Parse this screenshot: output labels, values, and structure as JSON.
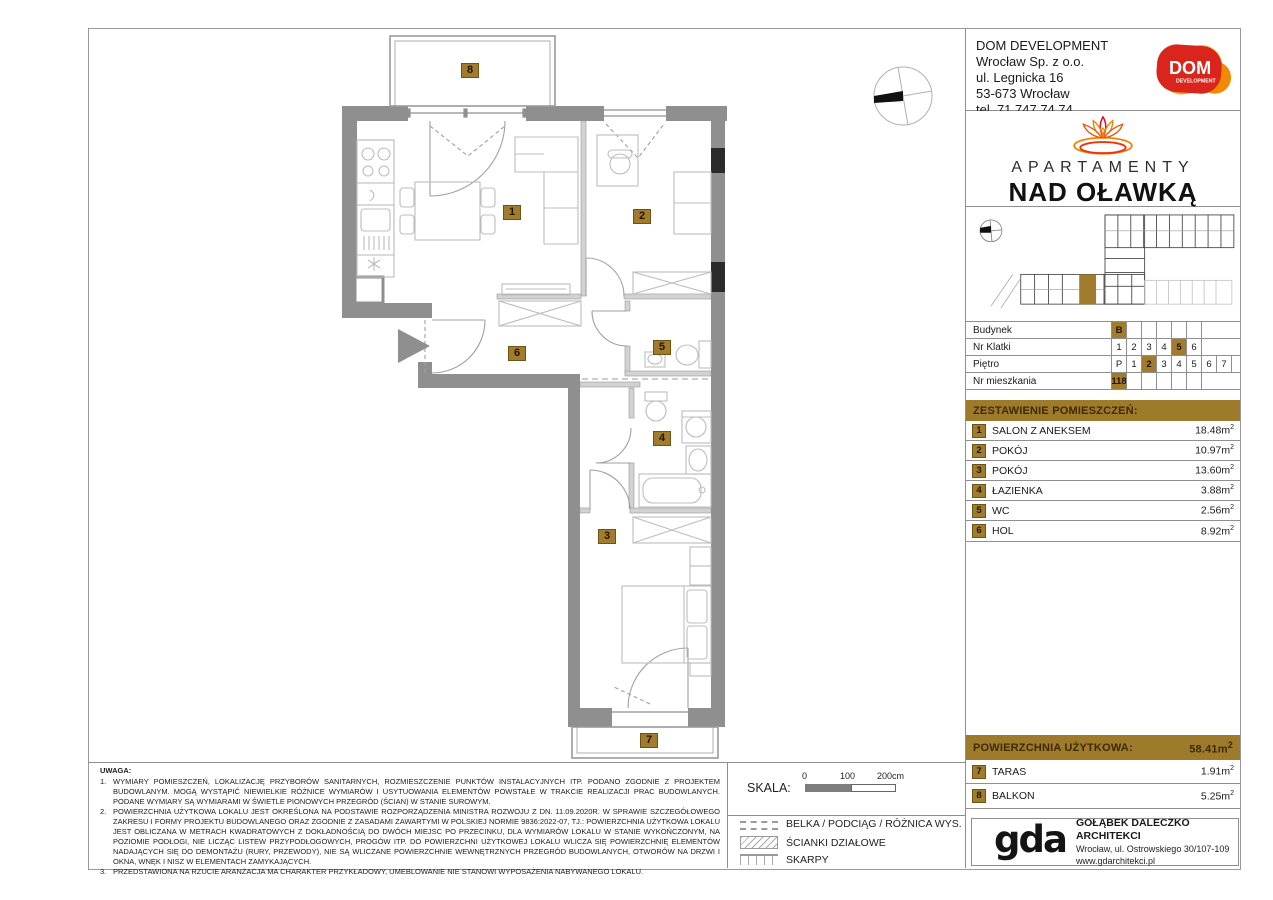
{
  "company": {
    "name": "DOM DEVELOPMENT",
    "lines": [
      "Wrocław Sp. z o.o.",
      "ul. Legnicka 16",
      "53-673 Wrocław",
      "tel. 71 747 74 74"
    ],
    "logo_text": "DOM",
    "logo_sub": "DEVELOPMENT"
  },
  "brand": {
    "line1": "APARTAMENTY",
    "line2": "NAD OŁAWKĄ"
  },
  "unit": {
    "rows": [
      {
        "label": "Budynek",
        "options": [
          "B",
          "",
          "",
          "",
          "",
          ""
        ],
        "selected": "B"
      },
      {
        "label": "Nr Klatki",
        "options": [
          "1",
          "2",
          "3",
          "4",
          "5",
          "6"
        ],
        "selected": "5"
      },
      {
        "label": "Piętro",
        "options": [
          "P",
          "1",
          "2",
          "3",
          "4",
          "5",
          "6",
          "7"
        ],
        "selected": "2"
      },
      {
        "label": "Nr mieszkania",
        "options": [
          "118",
          "",
          "",
          "",
          "",
          ""
        ],
        "selected": "118"
      }
    ]
  },
  "rooms": {
    "header": "ZESTAWIENIE POMIESZCZEŃ:",
    "items": [
      {
        "no": "1",
        "name": "SALON Z ANEKSEM",
        "area": "18.48"
      },
      {
        "no": "2",
        "name": "POKÓJ",
        "area": "10.97"
      },
      {
        "no": "3",
        "name": "POKÓJ",
        "area": "13.60"
      },
      {
        "no": "4",
        "name": "ŁAZIENKA",
        "area": "3.88"
      },
      {
        "no": "5",
        "name": "WC",
        "area": "2.56"
      },
      {
        "no": "6",
        "name": "HOL",
        "area": "8.92"
      }
    ]
  },
  "totals": {
    "header": "POWIERZCHNIA UŻYTKOWA:",
    "value": "58.41",
    "outdoor": [
      {
        "no": "7",
        "name": "TARAS",
        "area": "1.91"
      },
      {
        "no": "8",
        "name": "BALKON",
        "area": "5.25"
      }
    ]
  },
  "units": {
    "m": "m",
    "exp": "2"
  },
  "notes": {
    "title": "UWAGA:",
    "items": [
      {
        "no": "1.",
        "text": "WYMIARY POMIESZCZEŃ, LOKALIZACJĘ PRZYBORÓW SANITARNYCH, ROZMIESZCZENIE PUNKTÓW INSTALACYJNYCH ITP. PODANO ZGODNIE Z PROJEKTEM BUDOWLANYM. MOGĄ WYSTĄPIĆ NIEWIELKIE RÓŻNICE WYMIARÓW I USYTUOWANIA ELEMENTÓW POWSTAŁE W TRAKCIE REALIZACJI PRAC BUDOWLANYCH. PODANE WYMIARY SĄ WYMIARAMI W ŚWIETLE PIONOWYCH PRZEGRÓD (ŚCIAN) W STANIE SUROWYM."
      },
      {
        "no": "2.",
        "text": "POWIERZCHNIA UŻYTKOWA LOKALU JEST OKREŚLONA NA PODSTAWIE ROZPORZĄDZENIA MINISTRA ROZWOJU Z DN. 11.09.2020R. W SPRAWIE SZCZEGÓŁOWEGO ZAKRESU I FORMY PROJEKTU BUDOWLANEGO ORAZ ZGODNIE Z ZASADAMI ZAWARTYMI W POLSKIEJ NORMIE 9836:2022-07, TJ.: POWIERZCHNIA UŻYTKOWA LOKALU JEST OBLICZANA W METRACH KWADRATOWYCH Z DOKŁADNOŚCIĄ DO DWÓCH MIEJSC PO PRZECINKU, DLA WYMIARÓW LOKALU W STANIE WYKOŃCZONYM, NA POZIOMIE PODŁOGI, NIE LICZĄC LISTEW PRZYPODŁOGOWYCH, PROGÓW ITP. DO POWIERZCHNI UŻYTKOWEJ LOKALU WLICZA SIĘ POWIERZCHNIĘ ELEMENTÓW NADAJĄCYCH SIĘ DO DEMONTAŻU (RURY, PRZEWODY), NIE SĄ WLICZANE POWIERZCHNIE WEWNĘTRZNYCH PRZEGRÓD BUDOWLANYCH, OTWORÓW NA DRZWI I OKNA, WNĘK I NISZ W ELEMENTACH ZAMYKAJĄCYCH."
      },
      {
        "no": "3.",
        "text": "PRZEDSTAWIONA NA RZUCIE ARANŻACJA MA CHARAKTER PRZYKŁADOWY, UMEBLOWANIE NIE STANOWI WYPOSAŻENIA NABYWANEGO LOKALU."
      }
    ]
  },
  "scale": {
    "label": "SKALA:",
    "ticks": [
      "0",
      "100",
      "200cm"
    ]
  },
  "legend": {
    "items": [
      {
        "label": "BELKA / PODCIĄG / RÓŻNICA WYS."
      },
      {
        "label": "ŚCIANKI DZIAŁOWE"
      },
      {
        "label": "SKARPY"
      }
    ]
  },
  "architect": {
    "name": "GOŁĄBEK DALECZKO ARCHITEKCI",
    "address": "Wrocław, ul. Ostrowskiego 30/107-109",
    "website": "www.gdarchitekci.pl",
    "logo_text": "gda"
  },
  "colors": {
    "accent": "#9e7b2b",
    "wall": "#8f8f8f",
    "dom_red": "#da251d",
    "dom_orange": "#f6a21b"
  }
}
